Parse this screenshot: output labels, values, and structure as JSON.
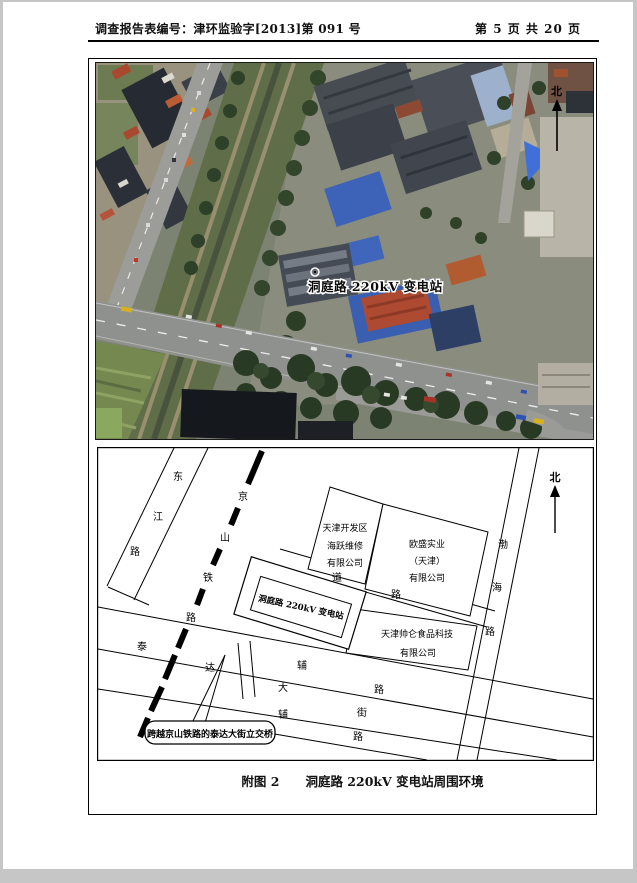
{
  "header": {
    "report_no": "调查报告表编号：津环监验字[2013]第 091 号",
    "page_info": "第 5 页 共 20 页"
  },
  "caption": {
    "figure_no": "附图 2",
    "title": "洞庭路 220kV 变电站周围环境"
  },
  "satellite": {
    "station_label": "洞庭路 220kV 变电站",
    "north_label": "北"
  },
  "map": {
    "north_label": "北",
    "roads": {
      "dongjiang_chars": [
        "东",
        "江",
        "路"
      ],
      "railway_chars": [
        "京",
        "山",
        "铁",
        "路"
      ],
      "taida_chars": [
        "泰",
        "达",
        "大",
        "街"
      ],
      "upper_aux_chars": [
        "辅",
        "路"
      ],
      "lower_aux_chars": [
        "辅",
        "路"
      ],
      "middle_road_chars": [
        "道",
        "路"
      ],
      "bohai_chars": [
        "渤",
        "海",
        "路"
      ]
    },
    "sites": {
      "substation": "洞庭路 220kV 变电站",
      "haiyue_lines": [
        "天津开发区",
        "海跃维修",
        "有限公司"
      ],
      "ousheng_lines": [
        "欧盛实业",
        "（天津）",
        "有限公司"
      ],
      "shuailun_lines": [
        "天津帅仑食品科技",
        "有限公司"
      ]
    },
    "callout": "跨越京山铁路的泰达大街立交桥"
  },
  "colors": {
    "page_bg": "#ffffff",
    "surround": "#c6c6c6",
    "ink": "#000000"
  }
}
